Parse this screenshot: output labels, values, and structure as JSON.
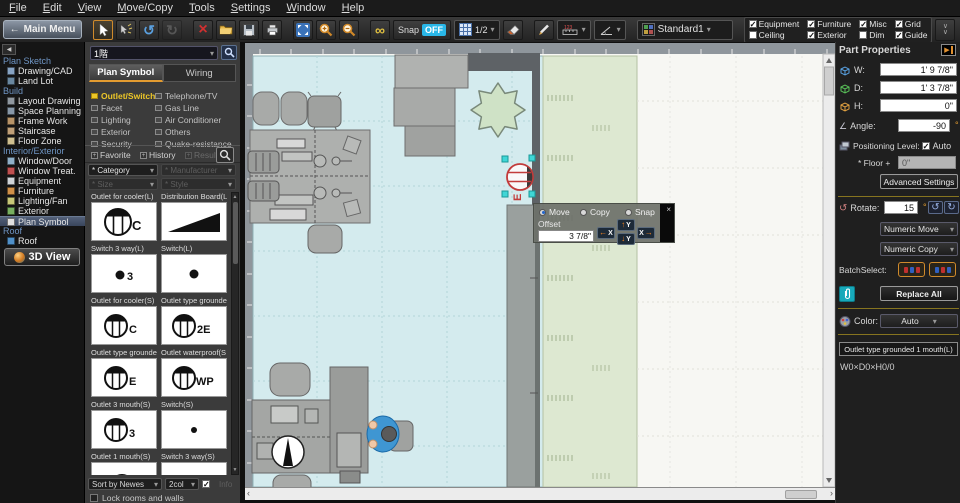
{
  "menu": [
    "File",
    "Edit",
    "View",
    "Move/Copy",
    "Tools",
    "Settings",
    "Window",
    "Help"
  ],
  "icons": {
    "back": "←",
    "undo": "↺",
    "redo": "↻",
    "delete": "×",
    "infinity": "∞",
    "caret": "▾",
    "up": "▲",
    "down": "▼",
    "left_tri": "◀",
    "right_tri": "▶",
    "check": "✓",
    "close": "×",
    "arrow_left": "←",
    "arrow_right": "→",
    "arrow_up": "↑",
    "arrow_down": "↓",
    "rot_ccw": "↺",
    "rot_cw": "↻",
    "angle": "∠",
    "scroll_left": "‹",
    "scroll_right": "›",
    "chevron_double": "∨∨",
    "measure_digits": "123"
  },
  "toolbar": {
    "main_menu": "Main Menu",
    "snap": "Snap",
    "snap_state": "OFF",
    "scale": "1/2",
    "preset": "Standard1",
    "checks": [
      {
        "label": "Equipment",
        "mark": "✓"
      },
      {
        "label": "Ceiling",
        "mark": ""
      },
      {
        "label": "Furniture",
        "mark": "✓"
      },
      {
        "label": "Exterior",
        "mark": "✓"
      },
      {
        "label": "Misc",
        "mark": "✓"
      },
      {
        "label": "Dim",
        "mark": ""
      },
      {
        "label": "Grid",
        "mark": "✓"
      },
      {
        "label": "Guide",
        "mark": "✓"
      }
    ]
  },
  "sidebar": {
    "headers": [
      "Plan Sketch",
      "Build",
      "Interior/Exterior",
      "Roof"
    ],
    "items": [
      "Drawing/CAD",
      "Land Lot",
      "Layout Drawing",
      "Space Planning",
      "Frame Work",
      "Staircase",
      "Floor Zone",
      "Window/Door",
      "Window Treat.",
      "Equipment",
      "Furniture",
      "Lighting/Fan",
      "Exterior",
      "Plan Symbol",
      "Roof"
    ],
    "view_button": "3D View"
  },
  "panel": {
    "floor": "1階",
    "tabs": [
      "Plan Symbol",
      "Wiring"
    ],
    "cats1": [
      {
        "l": "Outlet/Switch"
      },
      {
        "l": "Facet"
      },
      {
        "l": "Lighting"
      },
      {
        "l": "Exterior"
      },
      {
        "l": "Security"
      }
    ],
    "cats2": [
      {
        "l": "Telephone/TV"
      },
      {
        "l": "Gas Line"
      },
      {
        "l": "Air Conditioner"
      },
      {
        "l": "Others"
      },
      {
        "l": "Quake-resistance"
      }
    ],
    "links": [
      "Favorite",
      "History",
      "Result"
    ],
    "filters": [
      "* Category",
      "* Manufacturer",
      "* Size",
      "* Style"
    ],
    "symbols": [
      {
        "name": "Outlet for cooler(L)",
        "glyph": "C"
      },
      {
        "name": "Distribution Board(L",
        "glyph": ""
      },
      {
        "name": "Switch 3 way(L)",
        "glyph": "3"
      },
      {
        "name": "Switch(L)",
        "glyph": ""
      },
      {
        "name": "Outlet for cooler(S)",
        "glyph": "C"
      },
      {
        "name": "Outlet type grounde",
        "glyph": "2E"
      },
      {
        "name": "Outlet type grounde",
        "glyph": "E"
      },
      {
        "name": "Outlet waterproof(S",
        "glyph": "WP"
      },
      {
        "name": "Outlet 3 mouth(S)",
        "glyph": "3"
      },
      {
        "name": "Switch(S)",
        "glyph": ""
      },
      {
        "name": "Outlet 1 mouth(S)",
        "glyph": ""
      },
      {
        "name": "Switch 3 way(S)",
        "glyph": ""
      }
    ],
    "sort": "Sort by Newes",
    "cols": "2col",
    "info": "Info",
    "lock": "Lock rooms and walls"
  },
  "overlay": {
    "options": [
      "Move",
      "Copy",
      "Snap"
    ],
    "selected": "Move",
    "offset_label": "Offset",
    "offset_value": "3 7/8\"",
    "axis": [
      "X",
      "Y",
      "Y",
      "X"
    ]
  },
  "props": {
    "title": "Part Properties",
    "w_label": "W:",
    "w": "1' 9 7/8\"",
    "d_label": "D:",
    "d": "1' 3 7/8\"",
    "h_label": "H:",
    "h": "0\"",
    "angle_label": "Angle:",
    "angle": "-90",
    "deg": "°",
    "pos_label": "Positioning Level:",
    "auto": "Auto",
    "auto_mark": "✓",
    "floor_label": "* Floor +",
    "floor_val": "0\"",
    "advanced": "Advanced Settings",
    "rotate_label": "Rotate:",
    "rotate": "15",
    "move_dd": "Numeric Move",
    "copy_dd": "Numeric Copy",
    "batch": "BatchSelect:",
    "replace": "Replace All",
    "color_label": "Color:",
    "color": "Auto",
    "part_name": "Outlet type grounded 1 mouth(L)",
    "dims": "W0×D0×H0/0"
  }
}
